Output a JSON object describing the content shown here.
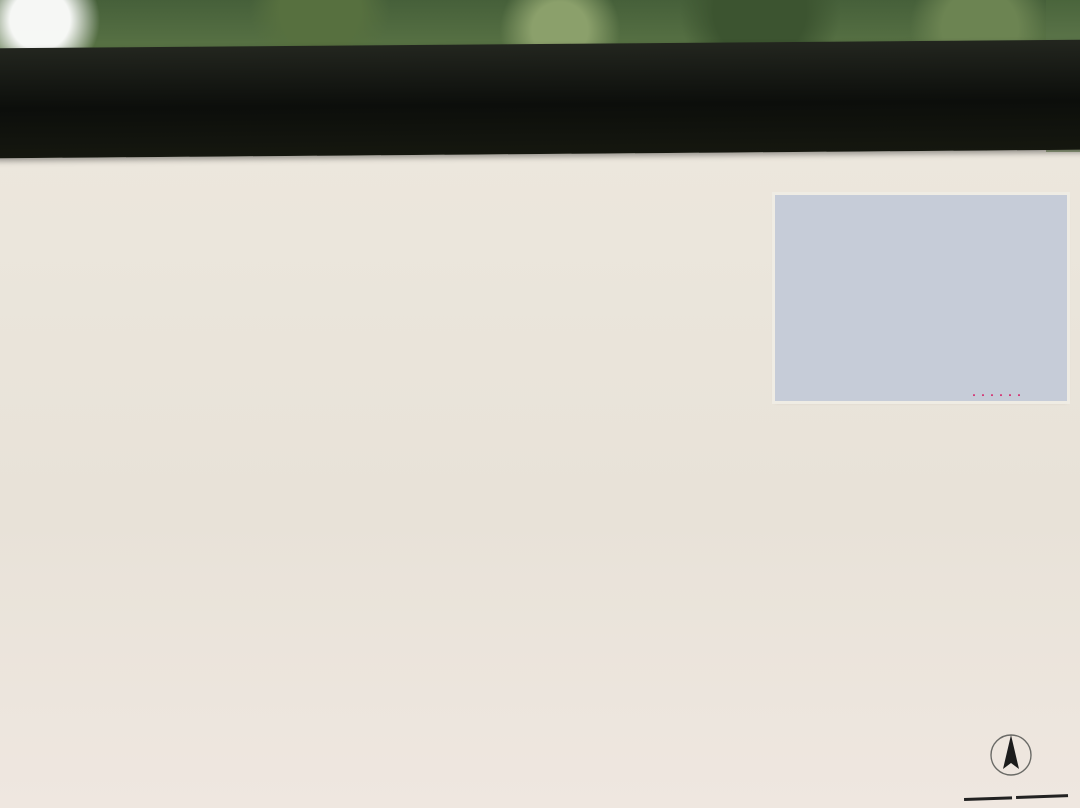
{
  "sign": {
    "prefix": "京都立",
    "title": "砧公園案内図",
    "en_line1": "Kinuta",
    "en_line2": "Park"
  },
  "notes": [
    "リーパーク内は以下のご利用となります",
    "ゴルフ、サッカー、ラグビー等や、団体の激しい運動は行わないでください。"
  ],
  "legend": {
    "title": "凡 例",
    "left": [
      {
        "icon": "toilet-icon",
        "label": "トイレ"
      },
      {
        "icon": "wheelchair-toilet-icon",
        "label": "車イス対応トイレ"
      },
      {
        "icon": "fountain-icon",
        "label": "水飲み場"
      },
      {
        "icon": "phone-icon",
        "label": "公衆電話"
      },
      {
        "icon": "bicycle-icon",
        "label": "駐輪場"
      },
      {
        "icon": "aed-icon",
        "label": "AED"
      }
    ],
    "right": [
      {
        "icon": "pergola-icon",
        "label": "パーゴラ"
      },
      {
        "icon": "azumaya-icon",
        "label": "あずまや"
      },
      {
        "icon": "shop-icon",
        "label": "売店"
      },
      {
        "icon": "busstop-icon",
        "label": "バス停"
      },
      {
        "icon": "busroute-icon",
        "label": "バス路線"
      },
      {
        "icon": "cycling-icon",
        "label": "サイクリングコース"
      }
    ]
  },
  "compass": {
    "north": "N"
  },
  "scale_ticks": [
    "0",
    "50",
    "100m"
  ],
  "promenade_note": "用賀プロムナード",
  "inset": {
    "park_label": "砧公園",
    "labels": [
      {
        "t": "日本大学高学部",
        "x": 48,
        "y": 28
      },
      {
        "t": "世田谷通り",
        "x": 92,
        "y": 24,
        "r": -20
      },
      {
        "t": "環八通り",
        "x": 152,
        "y": 36,
        "r": 75
      },
      {
        "t": "用賀小学校",
        "x": 190,
        "y": 30
      },
      {
        "t": "馬事公苑",
        "x": 250,
        "y": 18
      },
      {
        "t": "国立成育\n医療センター",
        "x": 44,
        "y": 58
      },
      {
        "t": "中央卸売市場",
        "x": 104,
        "y": 65
      },
      {
        "t": "世田谷\n清掃工場",
        "x": 162,
        "y": 72
      },
      {
        "t": "駒沢大学付属\n高等学校",
        "x": 232,
        "y": 55
      },
      {
        "t": "大蔵住宅",
        "x": 16,
        "y": 80
      },
      {
        "t": "国立衛生\n試験所",
        "x": 262,
        "y": 86
      },
      {
        "t": "世田谷美術館",
        "x": 162,
        "y": 99
      },
      {
        "t": "用賀中学校",
        "x": 196,
        "y": 110
      },
      {
        "t": "区立総合\n運動場",
        "x": 42,
        "y": 115
      },
      {
        "t": "砧公園通り",
        "x": 222,
        "y": 120,
        "r": -12
      },
      {
        "t": "砧公園",
        "x": 112,
        "y": 122,
        "red": true
      },
      {
        "t": "東名高速道路",
        "x": 118,
        "y": 150,
        "r": 8
      },
      {
        "t": "用賀駅",
        "x": 254,
        "y": 162,
        "red": true
      },
      {
        "t": "聖ドミニコ学園",
        "x": 126,
        "y": 180
      }
    ]
  },
  "map": {
    "current_location": "現在地",
    "labels": [
      {
        "t": "大蔵門",
        "x": 68,
        "y": 327,
        "s": "pw"
      },
      {
        "t": "ファミリーパーク",
        "x": 272,
        "y": 538,
        "s": "pw"
      },
      {
        "t": "子供の森",
        "x": 446,
        "y": 512,
        "s": "pw"
      },
      {
        "t": "芝生広場",
        "x": 315,
        "y": 411,
        "s": "pw"
      },
      {
        "t": "芝生広場",
        "x": 501,
        "y": 521,
        "s": "pw"
      },
      {
        "t": "芝生広場",
        "x": 281,
        "y": 580,
        "s": "pw"
      },
      {
        "t": "チリリン広場",
        "x": 388,
        "y": 591,
        "s": "pw"
      },
      {
        "t": "管理所",
        "x": 449,
        "y": 581,
        "s": "pw"
      },
      {
        "t": "小サッカー場",
        "x": 511,
        "y": 588,
        "s": "pw"
      },
      {
        "t": "世田谷美術館",
        "x": 462,
        "y": 397,
        "s": "pw"
      },
      {
        "t": "有料駐車場",
        "x": 589,
        "y": 374,
        "s": "pw"
      },
      {
        "t": "わくわく広場",
        "x": 648,
        "y": 489,
        "s": "pw"
      },
      {
        "t": "ねむの木広場",
        "x": 601,
        "y": 552,
        "s": "pw"
      },
      {
        "t": "正門",
        "x": 737,
        "y": 590,
        "s": "pw"
      },
      {
        "t": "風景の門",
        "x": 701,
        "y": 417,
        "s": "pw"
      },
      {
        "t": "野球場兼競技場",
        "x": 656,
        "y": 657,
        "s": "pw"
      },
      {
        "t": "（ヘリポート予定地）",
        "x": 656,
        "y": 677,
        "s": "pw2"
      },
      {
        "t": "A面",
        "x": 642,
        "y": 638,
        "s": "pw2"
      },
      {
        "t": "B面",
        "x": 726,
        "y": 683,
        "s": "pw2"
      },
      {
        "t": "門",
        "x": 8,
        "y": 568,
        "s": "pw"
      },
      {
        "t": "バードサンクチュアリー",
        "x": 120,
        "y": 404,
        "s": "py"
      },
      {
        "t": "みんなのひろば",
        "x": 626,
        "y": 446,
        "s": "py"
      },
      {
        "t": "出合いの広場",
        "x": 532,
        "y": 467,
        "s": "b"
      },
      {
        "t": "吊り橋",
        "x": 330,
        "y": 304,
        "s": "b"
      },
      {
        "t": "稲荷橋",
        "x": 344,
        "y": 228,
        "s": "bs"
      },
      {
        "t": "サイクリングコース",
        "x": 200,
        "y": 327,
        "s": "b"
      },
      {
        "t": "一の橋",
        "x": 243,
        "y": 400,
        "s": "b"
      },
      {
        "t": "二の橋",
        "x": 245,
        "y": 491,
        "s": "b"
      },
      {
        "t": "三の橋",
        "x": 160,
        "y": 542,
        "s": "b"
      },
      {
        "t": "四の橋",
        "x": 131,
        "y": 601,
        "s": "b"
      },
      {
        "t": "谷戸川",
        "x": 207,
        "y": 530,
        "s": "bs"
      },
      {
        "t": "観察窓",
        "x": 68,
        "y": 428,
        "s": "bs"
      },
      {
        "t": "野草園",
        "x": 188,
        "y": 569,
        "s": "b"
      },
      {
        "t": "梅林",
        "x": 595,
        "y": 497,
        "s": "bs"
      },
      {
        "t": "さわら並木",
        "x": 452,
        "y": 452,
        "s": "b"
      },
      {
        "t": "けやき並木",
        "x": 594,
        "y": 636,
        "s": "b",
        "r": 9
      },
      {
        "t": "砧大塚",
        "x": 557,
        "y": 679,
        "s": "bs"
      },
      {
        "t": "通用門",
        "x": 499,
        "y": 682,
        "s": "bs"
      },
      {
        "t": "サービスヤード",
        "x": 422,
        "y": 667,
        "s": "b"
      },
      {
        "t": "更衣室",
        "x": 471,
        "y": 609,
        "s": "bs"
      },
      {
        "t": "バラ園",
        "x": 681,
        "y": 513,
        "s": "bs"
      },
      {
        "t": "バラ園",
        "x": 514,
        "y": 643,
        "s": "bs"
      },
      {
        "t": "5号トイレ",
        "x": 143,
        "y": 258,
        "s": "bs"
      },
      {
        "t": "さくらの\nトイレ",
        "x": 203,
        "y": 386,
        "s": "bs"
      },
      {
        "t": "えのきの\nトイレ",
        "x": 262,
        "y": 465,
        "s": "bs"
      },
      {
        "t": "4号トイレ",
        "x": 322,
        "y": 549,
        "s": "bs"
      },
      {
        "t": "1号トイレ",
        "x": 488,
        "y": 653,
        "s": "bs"
      },
      {
        "t": "8号トイレ",
        "x": 400,
        "y": 370,
        "s": "bs"
      },
      {
        "t": "9号トイレ",
        "x": 481,
        "y": 467,
        "s": "bs"
      },
      {
        "t": "10号トイレ",
        "x": 595,
        "y": 416,
        "s": "bs"
      },
      {
        "t": "けやきの\nトイレ",
        "x": 236,
        "y": 631,
        "s": "bs"
      },
      {
        "t": "ねむのき\nトイレ",
        "x": 638,
        "y": 608,
        "s": "bs"
      },
      {
        "t": "入口",
        "x": 541,
        "y": 347,
        "s": "b"
      },
      {
        "t": "中央卸売市場",
        "x": 456,
        "y": 328,
        "s": "b"
      },
      {
        "t": "世田谷清掃工場",
        "x": 543,
        "y": 264,
        "s": "b"
      },
      {
        "t": "美術館",
        "x": 500,
        "y": 292,
        "s": "bs"
      },
      {
        "t": "美術館通り",
        "x": 470,
        "y": 347,
        "s": "b",
        "r": -9
      },
      {
        "t": "旧環八通り",
        "x": 488,
        "y": 260,
        "s": "b",
        "r": 64
      },
      {
        "t": "環八通り",
        "x": 644,
        "y": 262,
        "s": "b",
        "r": 64
      },
      {
        "t": "環八通り",
        "x": 772,
        "y": 650,
        "s": "b",
        "r": 78
      },
      {
        "t": "至　高井戸方面",
        "x": 566,
        "y": 224,
        "s": "b"
      },
      {
        "t": "東名高速道路",
        "x": 360,
        "y": 686,
        "s": "bsp",
        "r": 6
      },
      {
        "t": "名古屋方面",
        "x": 30,
        "y": 660,
        "s": "b"
      },
      {
        "t": "至　渋谷方面",
        "x": 756,
        "y": 762,
        "s": "b"
      },
      {
        "t": "至　瀬田方面",
        "x": 750,
        "y": 792,
        "s": "b"
      },
      {
        "t": "犬の散歩コース",
        "x": 336,
        "y": 656,
        "s": "bs",
        "r": 11
      },
      {
        "t": "八季の坂路",
        "x": 694,
        "y": 463,
        "s": "bs",
        "r": 76
      },
      {
        "t": "八季の坂路",
        "x": 707,
        "y": 553,
        "s": "bs",
        "r": 82
      },
      {
        "t": "パークブリッジ",
        "x": 753,
        "y": 493,
        "s": "b"
      },
      {
        "t": "緑化道路",
        "x": 685,
        "y": 392,
        "s": "bs",
        "r": -16
      },
      {
        "t": "砧公園緑地入口",
        "x": 802,
        "y": 551,
        "s": "bl"
      },
      {
        "t": "砧公園緑地入口",
        "x": 800,
        "y": 603,
        "s": "bl"
      },
      {
        "t": "美術館入口",
        "x": 604,
        "y": 283,
        "s": "bl"
      },
      {
        "t": "岡本一丁目",
        "x": 578,
        "y": 744,
        "s": "bl"
      },
      {
        "t": "千歳船橋駅行",
        "x": 654,
        "y": 222,
        "s": "bl"
      },
      {
        "t": "美術館駐車場入口",
        "x": 507,
        "y": 749,
        "s": "bs"
      },
      {
        "t": "（高架下）",
        "x": 484,
        "y": 763,
        "s": "bs"
      },
      {
        "t": "用賀駅行",
        "x": 703,
        "y": 280,
        "s": "r",
        "r": -14
      },
      {
        "t": "美術館",
        "x": 532,
        "y": 312,
        "s": "r"
      },
      {
        "t": "美術館",
        "x": 614,
        "y": 312,
        "s": "r"
      },
      {
        "t": "美術館",
        "x": 699,
        "y": 325,
        "s": "r"
      },
      {
        "t": "成城学園前駅行",
        "x": 26,
        "y": 234,
        "s": "r",
        "r": -55
      },
      {
        "t": "成城学園前駅行",
        "x": 408,
        "y": 758,
        "s": "r",
        "r": -8
      },
      {
        "t": "都立大学駅北口行",
        "x": 838,
        "y": 579,
        "s": "r"
      },
      {
        "t": "用賀中学校",
        "x": 786,
        "y": 593,
        "s": "r"
      },
      {
        "t": "駅北口行",
        "x": 20,
        "y": 691,
        "s": "r"
      },
      {
        "t": "学園",
        "x": 12,
        "y": 310,
        "s": "r"
      }
    ]
  }
}
